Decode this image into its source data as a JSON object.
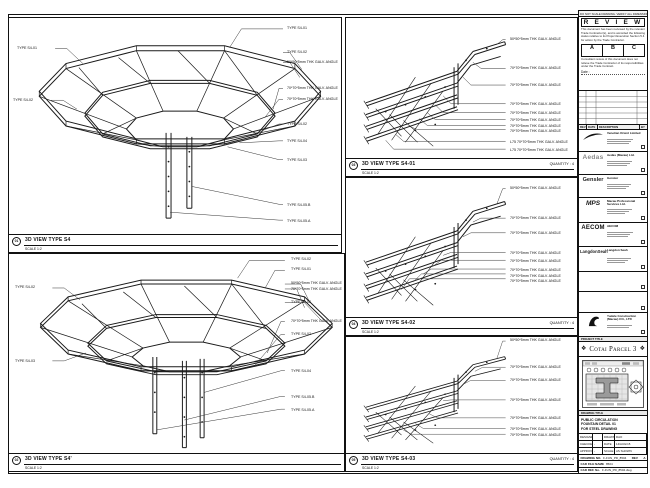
{
  "sheet": {
    "top_note": "DO NOT SCALE DRAWING. VERIFY ALL DIMENSIONS ON SITE."
  },
  "panels": {
    "a": {
      "number": "01",
      "title": "3D VIEW TYPE S4",
      "scale": "SCALE 1:2",
      "labels_left": [
        "TYPE S4-01",
        "TYPE S4-02"
      ],
      "labels_right": [
        "TYPE S4-01",
        "TYPE S4-02",
        "50*50*5mm THK GALV. ANGLE",
        "70*70*5mm THK GALV. ANGLE",
        "70*70*5mm THK GALV. ANGLE",
        "TYPE S4-02",
        "TYPE S4-04",
        "TYPE S4-03",
        "TYPE S4-05.B",
        "TYPE S4-05.A"
      ]
    },
    "b": {
      "number": "02",
      "title": "3D VIEW TYPE S4'",
      "scale": "SCALE 1:2",
      "labels_left": [
        "TYPE S4-02",
        "TYPE S4-03"
      ],
      "labels_right": [
        "TYPE S4-02",
        "TYPE S4-01",
        "50*50*5mm THK GALV. ANGLE",
        "70*70*5mm THK GALV. ANGLE",
        "TYPE S4-02",
        "70*70*5mm THK GALV. ANGLE",
        "TYPE S4-02",
        "TYPE S4-04",
        "TYPE S4-05.B",
        "TYPE S4-05.A"
      ]
    },
    "c": {
      "number": "03",
      "title": "3D VIEW TYPE S4-01",
      "scale": "SCALE 1:2",
      "quantity": "QUANTITY : 4",
      "labels": [
        "50*50*5mm THK GALV. ANGLE",
        "70*70*5mm THK GALV. ANGLE",
        "70*70*5mm THK GALV. ANGLE",
        "70*70*5mm THK GALV. ANGLE",
        "70*70*5mm THK GALV. ANGLE",
        "70*70*5mm THK GALV. ANGLE",
        "70*70*5mm THK GALV. ANGLE",
        "70*70*5mm THK GALV. ANGLE",
        "L75 70*70*5mm THK GALV. ANGLE",
        "L75 70*70*5mm THK GALV. ANGLE"
      ]
    },
    "d": {
      "number": "04",
      "title": "3D VIEW TYPE S4-02",
      "scale": "SCALE 1:2",
      "quantity": "QUANTITY : 4",
      "labels": [
        "50*50*5mm THK GALV. ANGLE",
        "70*70*5mm THK GALV. ANGLE",
        "70*70*5mm THK GALV. ANGLE",
        "70*70*5mm THK GALV. ANGLE",
        "70*70*5mm THK GALV. ANGLE",
        "70*70*5mm THK GALV. ANGLE",
        "70*70*5mm THK GALV. ANGLE",
        "70*70*5mm THK GALV. ANGLE"
      ]
    },
    "e": {
      "number": "05",
      "title": "3D VIEW TYPE S4-03",
      "scale": "SCALE 1:2",
      "quantity": "QUANTITY : 4",
      "labels": [
        "50*50*5mm THK GALV. ANGLE",
        "70*70*5mm THK GALV. ANGLE",
        "70*70*5mm THK GALV. ANGLE",
        "70*70*5mm THK GALV. ANGLE",
        "70*70*5mm THK GALV. ANGLE",
        "70*70*5mm THK GALV. ANGLE",
        "70*70*5mm THK GALV. ANGLE"
      ]
    }
  },
  "titleblock": {
    "stamp": {
      "title": "R E V I E W E D",
      "body1": "This document has been reviewed by the relevant Trade Contractor(s), and is accorded the following status relative to its Project Execution Section 5.4 for action by the Trade Contractor.",
      "status_a": "A",
      "status_b": "B",
      "status_c": "C",
      "body2": "Consultant review of this document does not relieve the Trade Contractor of its responsibilities under the Trade Contract.",
      "date_label": "Date :"
    },
    "revision_header": {
      "rev": "REV",
      "date": "DATE",
      "description": "DESCRIPTION",
      "by": "BY"
    },
    "consultants": {
      "c1": {
        "name": "Venetian Orient Limited"
      },
      "c2": {
        "logo": "Aedas",
        "name": "Aedas (Macau) Ltd."
      },
      "c3": {
        "logo": "Gensler",
        "name": "Gensler"
      },
      "c4": {
        "logo": "MPS",
        "name": "Macau Professional Services Ltd."
      },
      "c5": {
        "logo": "AECOM",
        "name": "AECOM"
      },
      "c6": {
        "logo": "LangdonSeah",
        "name": "Langdon Seah"
      },
      "c9": {
        "name": "Yudele Construction (Macau) CO., LTD"
      }
    },
    "project": {
      "label": "PROJECT TITLE",
      "name": "Cotai Parcel 3",
      "ornament": "❖"
    },
    "keyplan": {
      "label": "KEY PLAN"
    },
    "drawing_title": {
      "label": "DRAWING TITLE",
      "line1": "PUBLIC CIRCULATION",
      "line2": "FOUNTAIN DETAIL 01",
      "line3": "FOR STEEL DRAWING"
    },
    "signoff": {
      "rows": [
        [
          "DESIGNED",
          "",
          "DRAWN",
          "DAO"
        ],
        [
          "CHECKED",
          "-",
          "DATE",
          "14/AUG/15"
        ],
        [
          "APPROVED",
          "-",
          "SCALE",
          "AS SHOWN"
        ]
      ]
    },
    "numbers": {
      "drawing_no_label": "DRAWING NO.",
      "drawing_no": "F-FUN_PD_8504",
      "rev_label": "REV",
      "rev": "A",
      "cad_label": "CAD FILE NAME",
      "cad": "8504",
      "ref_label": "CAD REF. No.",
      "ref": "F-FUN_PD_8504.dwg"
    }
  }
}
